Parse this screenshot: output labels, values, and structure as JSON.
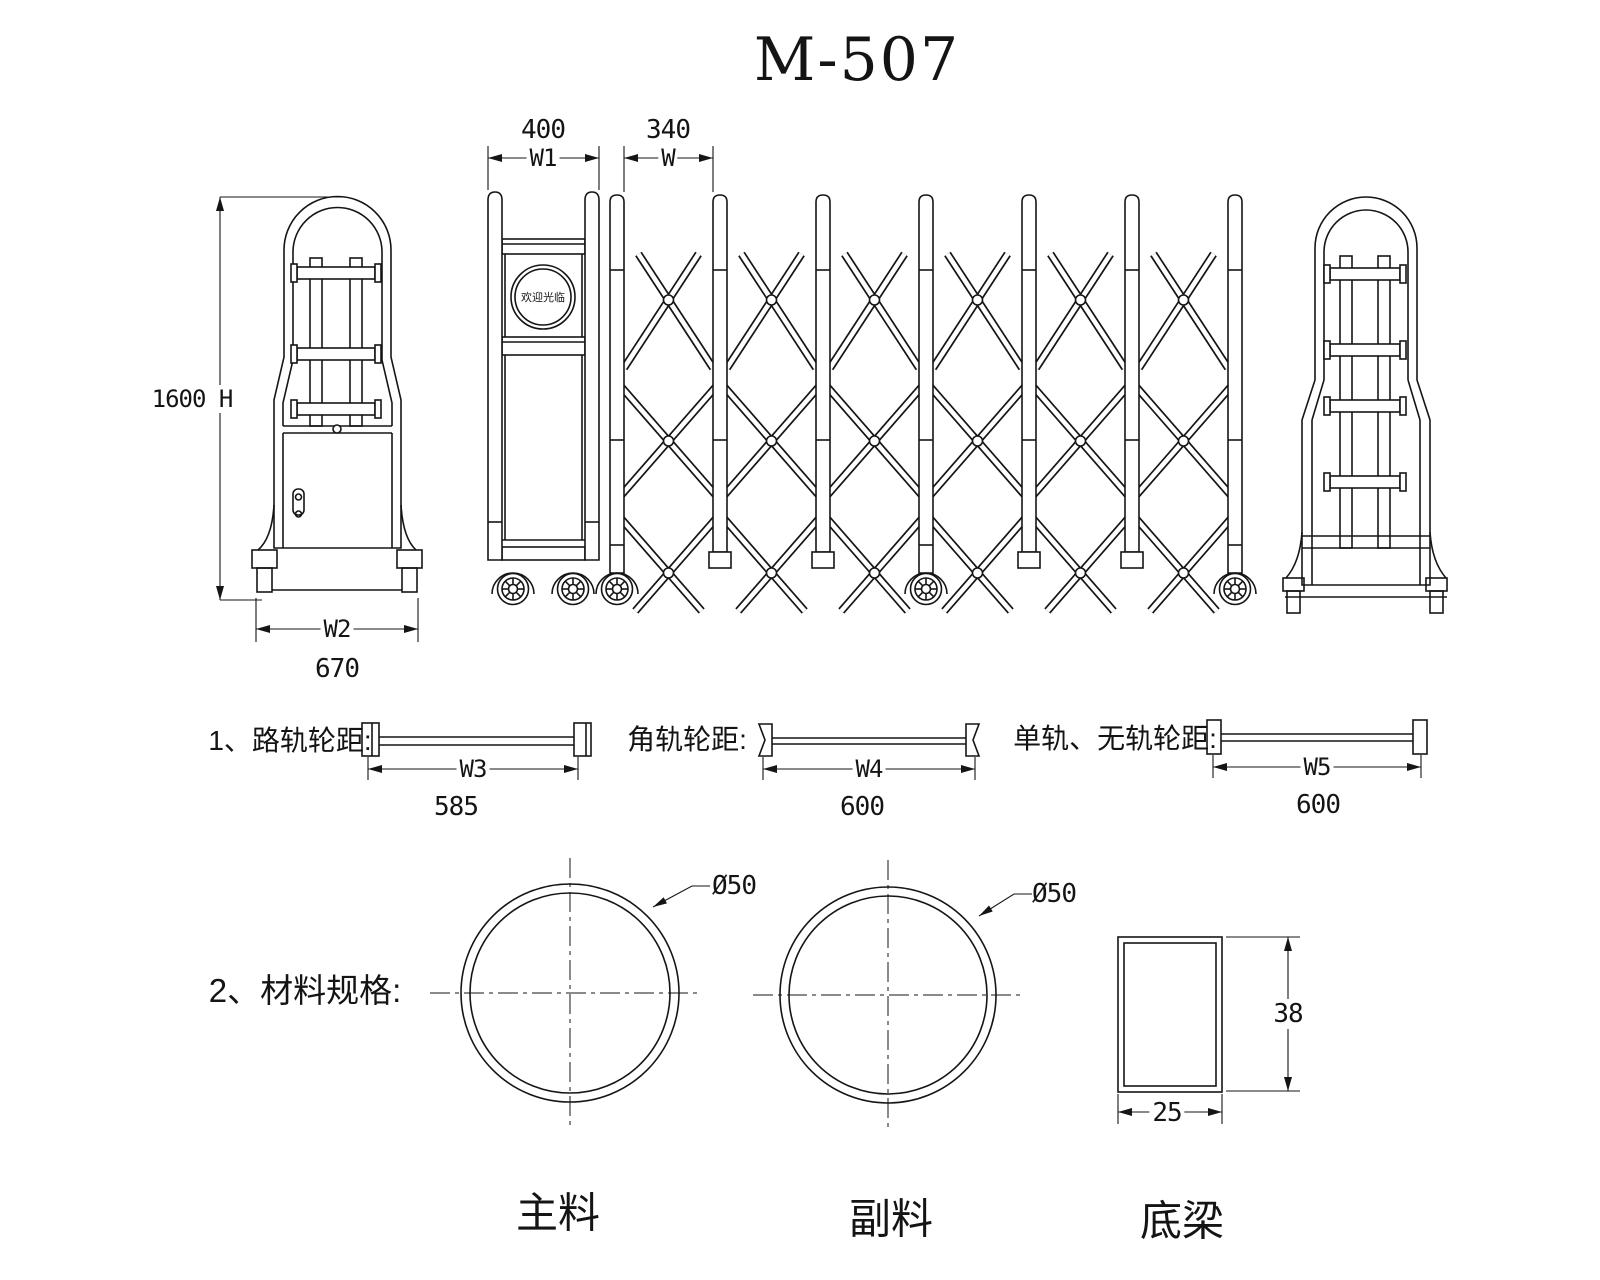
{
  "title": "M-507",
  "front_view": {
    "post_width": "400",
    "post_width_label": "W1",
    "bay_width": "340",
    "bay_width_label": "W",
    "height": "1600 H",
    "base_width_label": "W2",
    "base_width": "670",
    "welcome_sign": "欢迎光临"
  },
  "wheel_tracks": {
    "road_rail": {
      "label": "1、路轨轮距:",
      "dim_label": "W3",
      "value": "585"
    },
    "angle_rail": {
      "label": "角轨轮距:",
      "dim_label": "W4",
      "value": "600"
    },
    "mono_rail": {
      "label": "单轨、无轨轮距:",
      "dim_label": "W5",
      "value": "600"
    }
  },
  "materials": {
    "heading": "2、材料规格:",
    "main_pipe": {
      "diameter": "Ø50",
      "name": "主料"
    },
    "aux_pipe": {
      "diameter": "Ø50",
      "name": "副料"
    },
    "bottom_beam": {
      "height": "38",
      "width": "25",
      "name": "底梁"
    }
  }
}
